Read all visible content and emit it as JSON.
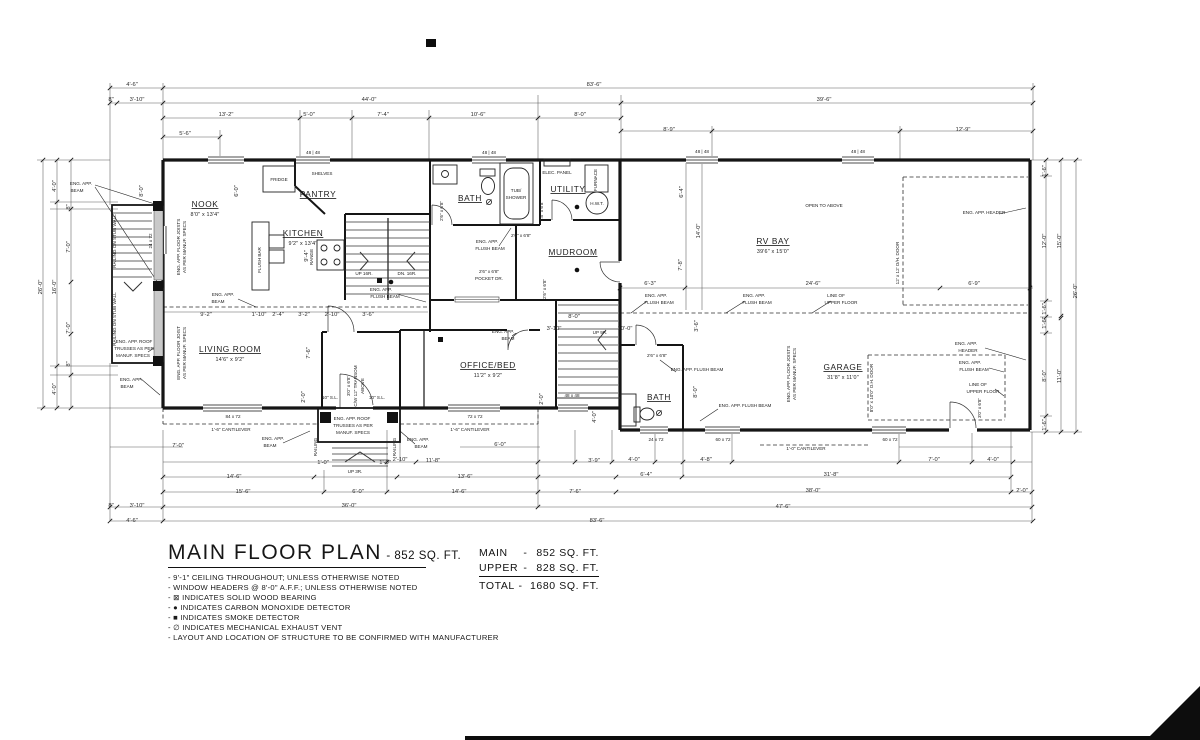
{
  "title_block": {
    "title": "MAIN FLOOR PLAN",
    "title_suffix": "- 852 SQ. FT.",
    "notes": [
      "- 9'-1\" CEILING THROUGHOUT; UNLESS OTHERWISE NOTED",
      "- WINDOW HEADERS @ 8'-0\" A.F.F.; UNLESS OTHERWISE NOTED",
      "- ⊠ INDICATES SOLID WOOD BEARING",
      "- ● INDICATES CARBON MONOXIDE DETECTOR",
      "- ■ INDICATES SMOKE DETECTOR",
      "- ∅ INDICATES MECHANICAL EXHAUST VENT",
      "- LAYOUT AND LOCATION OF STRUCTURE TO BE CONFIRMED WITH MANUFACTURER"
    ]
  },
  "area_table": {
    "rows": [
      {
        "label": "MAIN",
        "sep": "-",
        "value": "852 SQ. FT."
      },
      {
        "label": "UPPER",
        "sep": "-",
        "value": "828 SQ. FT."
      },
      {
        "label": "TOTAL",
        "sep": "-",
        "value": "1680 SQ. FT."
      }
    ]
  },
  "plan": {
    "rooms": [
      {
        "name": "NOOK",
        "size": "8'0\" x 13'4\"",
        "x": 205,
        "y": 207
      },
      {
        "name": "KITCHEN",
        "size": "9'2\" x 13'4\"",
        "x": 303,
        "y": 236
      },
      {
        "name": "PANTRY",
        "size": "",
        "x": 318,
        "y": 197
      },
      {
        "name": "BATH",
        "size": "",
        "x": 470,
        "y": 201
      },
      {
        "name": "UTILITY",
        "size": "",
        "x": 568,
        "y": 192
      },
      {
        "name": "MUDROOM",
        "size": "",
        "x": 573,
        "y": 255
      },
      {
        "name": "RV BAY",
        "size": "39'6\" x 15'0\"",
        "x": 773,
        "y": 244
      },
      {
        "name": "LIVING ROOM",
        "size": "14'6\" x 9'2\"",
        "x": 230,
        "y": 352
      },
      {
        "name": "OFFICE/BED",
        "size": "11'2\" x 9'2\"",
        "x": 488,
        "y": 368
      },
      {
        "name": "GARAGE",
        "size": "31'8\" x 11'0\"",
        "x": 843,
        "y": 370
      },
      {
        "name": "BATH",
        "size": "",
        "x": 659,
        "y": 400
      }
    ],
    "labels": [
      {
        "t": "FRIDGE",
        "x": 279,
        "y": 181,
        "fs": 4.6
      },
      {
        "t": "SHELVES",
        "x": 322,
        "y": 175,
        "fs": 4.3
      },
      {
        "t": "ELEC. PANEL",
        "x": 557,
        "y": 174,
        "fs": 4.3
      },
      {
        "t": "FURNACE",
        "x": 597,
        "y": 180,
        "r": -90,
        "fs": 4.3
      },
      {
        "t": "H.W.T.",
        "x": 597,
        "y": 205,
        "fs": 4.3
      },
      {
        "t": "TUB/",
        "x": 516,
        "y": 192,
        "fs": 4.3
      },
      {
        "t": "SHOWER",
        "x": 516,
        "y": 199,
        "fs": 4.3
      },
      {
        "t": "RANGE",
        "x": 313,
        "y": 257,
        "r": -90,
        "fs": 4.6
      },
      {
        "t": "FLUSH BAR",
        "x": 261,
        "y": 260,
        "r": -90,
        "fs": 4.3
      },
      {
        "t": "OPEN TO ABOVE",
        "x": 824,
        "y": 207,
        "fs": 4.8
      },
      {
        "t": "UP 16R.",
        "x": 364,
        "y": 275,
        "fs": 4.6
      },
      {
        "t": "DN. 16R.",
        "x": 407,
        "y": 275,
        "fs": 4.6
      },
      {
        "t": "UP 9R.",
        "x": 600,
        "y": 334,
        "fs": 4.4
      },
      {
        "t": "UP 3R.",
        "x": 355,
        "y": 473,
        "fs": 4.6
      },
      {
        "t": "RAILING",
        "x": 317,
        "y": 447,
        "r": -90,
        "fs": 4.2
      },
      {
        "t": "RAILING",
        "x": 396,
        "y": 447,
        "r": -90,
        "fs": 4.2
      },
      {
        "t": "RAILING ON STUB WALL",
        "x": 116,
        "y": 241,
        "r": -90,
        "fs": 4.2
      },
      {
        "t": "RAILING ON STUB WALL",
        "x": 116,
        "y": 319,
        "r": -90,
        "fs": 4.2
      },
      {
        "t": "2'6\" x 6'8\"",
        "x": 443,
        "y": 211,
        "r": -90,
        "fs": 4.2
      },
      {
        "t": "2'8\" x 6'8\"",
        "x": 543,
        "y": 211,
        "r": -90,
        "fs": 4.2
      },
      {
        "t": "2'6\" x 6'8\"",
        "x": 521,
        "y": 237,
        "fs": 4.2
      },
      {
        "t": "2'6\" x 6'8\"",
        "x": 489,
        "y": 273,
        "fs": 4.2
      },
      {
        "t": "POCKET DR.",
        "x": 489,
        "y": 280,
        "fs": 4.2
      },
      {
        "t": "2'6\" x 6'8\"",
        "x": 546,
        "y": 289,
        "r": -90,
        "fs": 4.2
      },
      {
        "t": "3'0\" x 6'8\"",
        "x": 350,
        "y": 386,
        "r": -90,
        "fs": 4.1
      },
      {
        "t": "C/W 12\" TRANSOM",
        "x": 357,
        "y": 386,
        "r": -90,
        "fs": 4.1
      },
      {
        "t": "ABOVE",
        "x": 364,
        "y": 386,
        "r": -90,
        "fs": 4.1
      },
      {
        "t": "10\" S.L.",
        "x": 330,
        "y": 399,
        "fs": 4.2
      },
      {
        "t": "10\" S.L.",
        "x": 377,
        "y": 399,
        "fs": 4.2
      },
      {
        "t": "12' x 12' O/H. DOOR",
        "x": 899,
        "y": 263,
        "r": -90,
        "fs": 4.3
      },
      {
        "t": "8'0\" x 10'0\" O.H. DOOR",
        "x": 873,
        "y": 388,
        "r": -90,
        "fs": 4.3
      },
      {
        "t": "3'0\" x 6'8\"",
        "x": 981,
        "y": 408,
        "r": -90,
        "fs": 4.2
      },
      {
        "t": "2'6\" x 6'8\"",
        "x": 657,
        "y": 357,
        "fs": 4.1
      },
      {
        "t": "48 | 48",
        "x": 313,
        "y": 154,
        "fs": 4.2
      },
      {
        "t": "48 | 48",
        "x": 489,
        "y": 154,
        "fs": 4.2
      },
      {
        "t": "48 | 48",
        "x": 702,
        "y": 153,
        "fs": 4.2
      },
      {
        "t": "48 | 48",
        "x": 858,
        "y": 153,
        "fs": 4.2
      },
      {
        "t": "84 x 72",
        "x": 233,
        "y": 418,
        "fs": 4.2
      },
      {
        "t": "72 x 72",
        "x": 475,
        "y": 418,
        "fs": 4.2
      },
      {
        "t": "24 x 72",
        "x": 152,
        "y": 241,
        "r": -90,
        "fs": 4.2
      },
      {
        "t": "48 x 48",
        "x": 572,
        "y": 397,
        "fs": 4.2
      },
      {
        "t": "24 x 72",
        "x": 656,
        "y": 441,
        "fs": 4.2
      },
      {
        "t": "60 x 72",
        "x": 723,
        "y": 441,
        "fs": 4.2
      },
      {
        "t": "60 x 72",
        "x": 890,
        "y": 441,
        "fs": 4.2
      },
      {
        "t": "ENG. APP.",
        "x": 81,
        "y": 185,
        "fs": 4.6
      },
      {
        "t": "BEAM",
        "x": 77,
        "y": 192,
        "fs": 4.6
      },
      {
        "t": "ENG. APP.",
        "x": 131,
        "y": 381,
        "fs": 4.6
      },
      {
        "t": "BEAM",
        "x": 127,
        "y": 388,
        "fs": 4.6
      },
      {
        "t": "ENG. APP. ROOF",
        "x": 134,
        "y": 343,
        "fs": 4.4
      },
      {
        "t": "TRUSSES AS PER",
        "x": 134,
        "y": 350,
        "fs": 4.4
      },
      {
        "t": "MANUF. SPECS",
        "x": 133,
        "y": 357,
        "fs": 4.4
      },
      {
        "t": "ENG. APP. FLOOR JOISTS",
        "x": 180,
        "y": 247,
        "r": -90,
        "fs": 4.0
      },
      {
        "t": "AS PER MANUF. SPECS",
        "x": 186,
        "y": 247,
        "r": -90,
        "fs": 4.0
      },
      {
        "t": "ENG. APP. FLOOR JOIST",
        "x": 180,
        "y": 353,
        "r": -90,
        "fs": 4.0
      },
      {
        "t": "AS PER MANUF. SPECS",
        "x": 186,
        "y": 353,
        "r": -90,
        "fs": 4.0
      },
      {
        "t": "ENG. APP.",
        "x": 223,
        "y": 296,
        "fs": 4.6
      },
      {
        "t": "BEAM",
        "x": 218,
        "y": 303,
        "fs": 4.6
      },
      {
        "t": "ENG. APP.",
        "x": 381,
        "y": 291,
        "fs": 4.6
      },
      {
        "t": "FLUSH BEAM",
        "x": 385,
        "y": 298,
        "fs": 4.6
      },
      {
        "t": "ENG. APP.",
        "x": 487,
        "y": 243,
        "fs": 4.6
      },
      {
        "t": "FLUSH BEAM",
        "x": 490,
        "y": 250,
        "fs": 4.6
      },
      {
        "t": "ENG. APP.",
        "x": 503,
        "y": 333,
        "fs": 4.6
      },
      {
        "t": "BEAM",
        "x": 508,
        "y": 340,
        "fs": 4.6
      },
      {
        "t": "ENG. APP.",
        "x": 656,
        "y": 297,
        "fs": 4.6
      },
      {
        "t": "FLUSH BEAM",
        "x": 659,
        "y": 304,
        "fs": 4.6
      },
      {
        "t": "ENG. APP.",
        "x": 754,
        "y": 297,
        "fs": 4.6
      },
      {
        "t": "FLUSH BEAM",
        "x": 757,
        "y": 304,
        "fs": 4.6
      },
      {
        "t": "LINE OF",
        "x": 836,
        "y": 297,
        "fs": 4.6
      },
      {
        "t": "UPPER FLOOR",
        "x": 841,
        "y": 304,
        "fs": 4.6
      },
      {
        "t": "ENG. APP. HEADER",
        "x": 984,
        "y": 214,
        "fs": 4.6
      },
      {
        "t": "ENG. APP. FLUSH BEAM",
        "x": 697,
        "y": 371,
        "fs": 4.4
      },
      {
        "t": "ENG. APP. FLUSH BEAM",
        "x": 745,
        "y": 407,
        "fs": 4.4
      },
      {
        "t": "ENG. APP.",
        "x": 966,
        "y": 345,
        "fs": 4.6
      },
      {
        "t": "HEADER",
        "x": 968,
        "y": 352,
        "fs": 4.6
      },
      {
        "t": "ENG. APP.",
        "x": 970,
        "y": 364,
        "fs": 4.6
      },
      {
        "t": "FLUSH BEAM",
        "x": 974,
        "y": 371,
        "fs": 4.6
      },
      {
        "t": "LINE OF",
        "x": 978,
        "y": 386,
        "fs": 4.6
      },
      {
        "t": "UPPER FLOOR",
        "x": 983,
        "y": 393,
        "fs": 4.6
      },
      {
        "t": "ENG. APP. FLOOR JOISTS",
        "x": 790,
        "y": 374,
        "r": -90,
        "fs": 4.0
      },
      {
        "t": "AS PER MANUF. SPECS",
        "x": 796,
        "y": 374,
        "r": -90,
        "fs": 4.0
      },
      {
        "t": "ENG. APP. ROOF",
        "x": 352,
        "y": 420,
        "fs": 4.3
      },
      {
        "t": "TRUSSES AS PER",
        "x": 353,
        "y": 427,
        "fs": 4.3
      },
      {
        "t": "MANUF. SPECS",
        "x": 353,
        "y": 434,
        "fs": 4.3
      },
      {
        "t": "ENG. APP.",
        "x": 273,
        "y": 440,
        "fs": 4.6
      },
      {
        "t": "BEAM",
        "x": 270,
        "y": 447,
        "fs": 4.6
      },
      {
        "t": "ENG. APP.",
        "x": 418,
        "y": 441,
        "fs": 4.6
      },
      {
        "t": "BEAM",
        "x": 421,
        "y": 448,
        "fs": 4.6
      },
      {
        "t": "1'-6\" CANTILEVER",
        "x": 231,
        "y": 431,
        "fs": 4.3
      },
      {
        "t": "1'-6\" CANTILEVER",
        "x": 470,
        "y": 431,
        "fs": 4.3
      },
      {
        "t": "1'-0\" CANTILEVER",
        "x": 806,
        "y": 450,
        "fs": 4.3
      }
    ],
    "dims": [
      {
        "t": "4'-6\"",
        "x": 132,
        "y": 86
      },
      {
        "t": "83'-6\"",
        "x": 594,
        "y": 86
      },
      {
        "t": "8\"",
        "x": 111,
        "y": 101,
        "fs": 4.8
      },
      {
        "t": "3'-10\"",
        "x": 137,
        "y": 101
      },
      {
        "t": "44'-0\"",
        "x": 369,
        "y": 101
      },
      {
        "t": "39'-6\"",
        "x": 824,
        "y": 101
      },
      {
        "t": "13'-2\"",
        "x": 226,
        "y": 116
      },
      {
        "t": "5'-0\"",
        "x": 309,
        "y": 116
      },
      {
        "t": "7'-4\"",
        "x": 383,
        "y": 116
      },
      {
        "t": "10'-6\"",
        "x": 478,
        "y": 116
      },
      {
        "t": "8'-0\"",
        "x": 580,
        "y": 116
      },
      {
        "t": "8'-9\"",
        "x": 669,
        "y": 131
      },
      {
        "t": "12'-9\"",
        "x": 963,
        "y": 131
      },
      {
        "t": "5'-6\"",
        "x": 185,
        "y": 135
      },
      {
        "t": "4'-0\"",
        "x": 56,
        "y": 186,
        "r": -90
      },
      {
        "t": "8\"",
        "x": 70,
        "y": 207,
        "r": -90,
        "fs": 4.8
      },
      {
        "t": "7'-0\"",
        "x": 70,
        "y": 247,
        "r": -90
      },
      {
        "t": "16'-0\"",
        "x": 56,
        "y": 287,
        "r": -90
      },
      {
        "t": "7'-0\"",
        "x": 70,
        "y": 328,
        "r": -90
      },
      {
        "t": "8\"",
        "x": 70,
        "y": 364,
        "r": -90,
        "fs": 4.8
      },
      {
        "t": "4'-0\"",
        "x": 56,
        "y": 389,
        "r": -90
      },
      {
        "t": "26'-0\"",
        "x": 42,
        "y": 287,
        "r": -90
      },
      {
        "t": "8'-0\"",
        "x": 143,
        "y": 191,
        "r": -90,
        "fs": 5
      },
      {
        "t": "1'-6\"",
        "x": 1046,
        "y": 171,
        "r": -90,
        "fs": 4.8
      },
      {
        "t": "12'-0\"",
        "x": 1046,
        "y": 241,
        "r": -90
      },
      {
        "t": "15'-0\"",
        "x": 1061,
        "y": 241,
        "r": -90
      },
      {
        "t": "26'-0\"",
        "x": 1077,
        "y": 291,
        "r": -90
      },
      {
        "t": "1'-6\"",
        "x": 1046,
        "y": 309,
        "r": -90,
        "fs": 4.8
      },
      {
        "t": "1'-6\"",
        "x": 1046,
        "y": 323,
        "r": -90,
        "fs": 4.8
      },
      {
        "t": "8'-0\"",
        "x": 1046,
        "y": 376,
        "r": -90
      },
      {
        "t": "11'-0\"",
        "x": 1061,
        "y": 376,
        "r": -90
      },
      {
        "t": "1'-6\"",
        "x": 1046,
        "y": 425,
        "r": -90,
        "fs": 4.8
      },
      {
        "t": "7'-0\"",
        "x": 178,
        "y": 447
      },
      {
        "t": "6'-0\"",
        "x": 500,
        "y": 446
      },
      {
        "t": "1'-0\"",
        "x": 323,
        "y": 464,
        "fs": 4.4
      },
      {
        "t": "1'-0\"",
        "x": 385,
        "y": 464,
        "fs": 4.4
      },
      {
        "t": "2'-10\"",
        "x": 400,
        "y": 461
      },
      {
        "t": "11'-8\"",
        "x": 433,
        "y": 462
      },
      {
        "t": "3'-9\"",
        "x": 594,
        "y": 462
      },
      {
        "t": "4'-0\"",
        "x": 634,
        "y": 461
      },
      {
        "t": "4'-8\"",
        "x": 706,
        "y": 461
      },
      {
        "t": "7'-0\"",
        "x": 934,
        "y": 461
      },
      {
        "t": "4'-0\"",
        "x": 993,
        "y": 461
      },
      {
        "t": "14'-6\"",
        "x": 234,
        "y": 478
      },
      {
        "t": "13'-6\"",
        "x": 465,
        "y": 478
      },
      {
        "t": "6'-4\"",
        "x": 646,
        "y": 476
      },
      {
        "t": "31'-8\"",
        "x": 831,
        "y": 476
      },
      {
        "t": "15'-6\"",
        "x": 243,
        "y": 493
      },
      {
        "t": "6'-0\"",
        "x": 358,
        "y": 493
      },
      {
        "t": "14'-6\"",
        "x": 459,
        "y": 493
      },
      {
        "t": "7'-6\"",
        "x": 575,
        "y": 493
      },
      {
        "t": "38'-0\"",
        "x": 813,
        "y": 492
      },
      {
        "t": "2'-0\"",
        "x": 1022,
        "y": 492
      },
      {
        "t": "8\"",
        "x": 111,
        "y": 507,
        "fs": 4.8
      },
      {
        "t": "3'-10\"",
        "x": 137,
        "y": 507
      },
      {
        "t": "36'-0\"",
        "x": 349,
        "y": 507
      },
      {
        "t": "47'-6\"",
        "x": 783,
        "y": 508
      },
      {
        "t": "4'-6\"",
        "x": 132,
        "y": 522
      },
      {
        "t": "83'-6\"",
        "x": 597,
        "y": 522
      },
      {
        "t": "6'-0\"",
        "x": 238,
        "y": 191,
        "r": -90,
        "fs": 5
      },
      {
        "t": "9'-4\"",
        "x": 308,
        "y": 256,
        "r": -90,
        "fs": 5
      },
      {
        "t": "9'-2\"",
        "x": 206,
        "y": 316,
        "fs": 5
      },
      {
        "t": "1'-10\"",
        "x": 259,
        "y": 316,
        "fs": 4.4
      },
      {
        "t": "2'-4\"",
        "x": 278,
        "y": 316,
        "fs": 4.4
      },
      {
        "t": "3'-2\"",
        "x": 304,
        "y": 316,
        "fs": 4.4
      },
      {
        "t": "2'-10\"",
        "x": 332,
        "y": 316,
        "fs": 4.4
      },
      {
        "t": "3'-6\"",
        "x": 368,
        "y": 316,
        "fs": 4.4
      },
      {
        "t": "7'-6\"",
        "x": 310,
        "y": 353,
        "r": -90,
        "fs": 4.6
      },
      {
        "t": "2'-0\"",
        "x": 305,
        "y": 397,
        "r": -90,
        "fs": 4.4
      },
      {
        "t": "2'-0\"",
        "x": 543,
        "y": 399,
        "r": -90,
        "fs": 4.4
      },
      {
        "t": "4'-0\"",
        "x": 596,
        "y": 417,
        "r": -90,
        "fs": 4.4
      },
      {
        "t": "8'-0\"",
        "x": 574,
        "y": 318,
        "fs": 5
      },
      {
        "t": "3'-10\"",
        "x": 554,
        "y": 330,
        "fs": 5
      },
      {
        "t": "10'-0\"",
        "x": 625,
        "y": 330,
        "fs": 5
      },
      {
        "t": "6'-3\"",
        "x": 650,
        "y": 285,
        "fs": 5
      },
      {
        "t": "24'-6\"",
        "x": 813,
        "y": 285,
        "fs": 5
      },
      {
        "t": "6'-9\"",
        "x": 974,
        "y": 285,
        "fs": 5
      },
      {
        "t": "6'-4\"",
        "x": 683,
        "y": 192,
        "r": -90,
        "fs": 5
      },
      {
        "t": "14'-0\"",
        "x": 700,
        "y": 231,
        "r": -90,
        "fs": 5
      },
      {
        "t": "7'-8\"",
        "x": 682,
        "y": 265,
        "r": -90,
        "fs": 5
      },
      {
        "t": "3'-6\"",
        "x": 698,
        "y": 326,
        "r": -90,
        "fs": 4.4
      },
      {
        "t": "8'-0\"",
        "x": 697,
        "y": 392,
        "r": -90,
        "fs": 4.6
      }
    ]
  }
}
